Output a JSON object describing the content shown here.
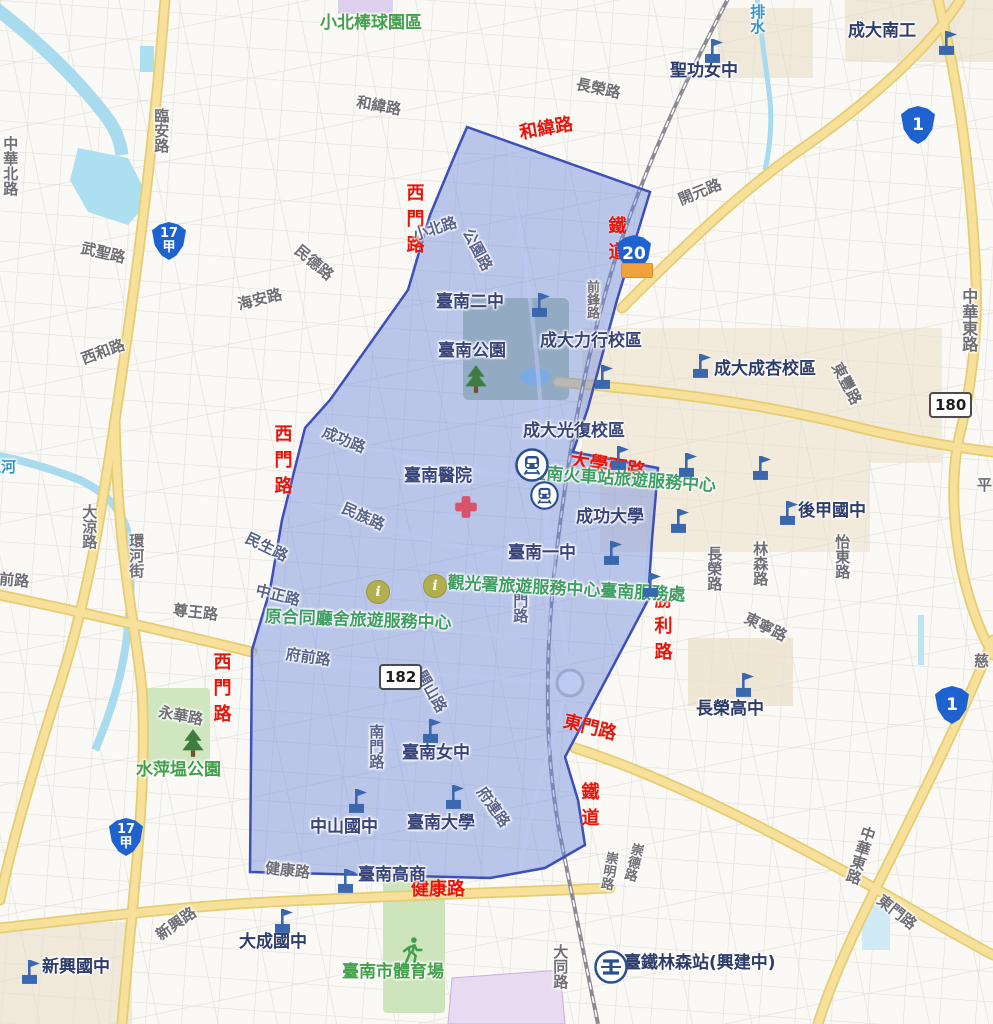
{
  "title": "臺南市街道地圖（藍色標示範圍）",
  "colors": {
    "highlight_fill": "rgba(106,136,222,0.45)",
    "highlight_stroke": "#3d4fb8",
    "annotation_red": "#e8150b",
    "place_navy": "#2e3c6a",
    "service_green": "#3f9e63",
    "park_green": "#43a04b",
    "road_gray": "#6e6e74",
    "water_blue": "#3a93c8",
    "major_road_yellow": "#f6df92",
    "railway_gray": "#8b8b93"
  },
  "highlight_region": {
    "points": "467,127 650,192 617,300 588,408 573,452 658,468 652,540 648,600 565,757 578,800 585,845 545,868 490,878 250,872 252,650 270,590 282,520 305,428 330,400 408,290 430,215 452,162"
  },
  "map": {
    "labels": [
      {
        "t": "和緯路",
        "x": 518,
        "y": 124,
        "r": -10,
        "c": "red"
      },
      {
        "t": "西門路",
        "x": 404,
        "y": 183,
        "v": 1,
        "c": "red"
      },
      {
        "t": "鐵道",
        "x": 606,
        "y": 216,
        "v": 1,
        "c": "red"
      },
      {
        "t": "西門路",
        "x": 272,
        "y": 424,
        "v": 1,
        "c": "red"
      },
      {
        "t": "大學西路",
        "x": 572,
        "y": 450,
        "r": 9,
        "c": "red",
        "s": 19
      },
      {
        "t": "勝利路",
        "x": 652,
        "y": 590,
        "v": 1,
        "c": "red"
      },
      {
        "t": "東門路",
        "x": 566,
        "y": 712,
        "r": 14,
        "c": "red"
      },
      {
        "t": "鐵道",
        "x": 579,
        "y": 782,
        "v": 1,
        "c": "red"
      },
      {
        "t": "健康路",
        "x": 411,
        "y": 880,
        "c": "red"
      },
      {
        "t": "西門路",
        "x": 211,
        "y": 652,
        "v": 1,
        "c": "red"
      },
      {
        "t": "中華北路",
        "x": 2,
        "y": 136,
        "v": 1,
        "c": "road"
      },
      {
        "t": "臨安路",
        "x": 153,
        "y": 108,
        "v": 1,
        "c": "road"
      },
      {
        "t": "武聖路",
        "x": 83,
        "y": 240,
        "r": 13,
        "c": "road"
      },
      {
        "t": "西和路",
        "x": 79,
        "y": 352,
        "r": -20,
        "c": "road"
      },
      {
        "t": "海安路",
        "x": 236,
        "y": 297,
        "r": -14,
        "c": "road"
      },
      {
        "t": "和緯路",
        "x": 358,
        "y": 94,
        "r": 10,
        "c": "road"
      },
      {
        "t": "長榮路",
        "x": 578,
        "y": 76,
        "r": 12,
        "c": "road"
      },
      {
        "t": "開元路",
        "x": 676,
        "y": 193,
        "r": -22,
        "c": "road"
      },
      {
        "t": "民德路",
        "x": 302,
        "y": 242,
        "r": 40,
        "c": "road"
      },
      {
        "t": "前鋒路",
        "x": 584,
        "y": 280,
        "v": 1,
        "c": "road",
        "s": 13
      },
      {
        "t": "尊王路",
        "x": 174,
        "y": 602,
        "r": 6,
        "c": "road"
      },
      {
        "t": "永華路",
        "x": 160,
        "y": 704,
        "r": 10,
        "c": "road"
      },
      {
        "t": "環河街",
        "x": 128,
        "y": 533,
        "v": 1,
        "c": "road"
      },
      {
        "t": "大涼路",
        "x": 81,
        "y": 504,
        "v": 1,
        "c": "road"
      },
      {
        "t": "前路",
        "x": 0,
        "y": 571,
        "r": 5,
        "c": "road"
      },
      {
        "t": "大同路",
        "x": 552,
        "y": 944,
        "v": 1,
        "c": "road"
      },
      {
        "t": "東門路",
        "x": 884,
        "y": 892,
        "r": 38,
        "c": "road"
      },
      {
        "t": "崇明路",
        "x": 604,
        "y": 850,
        "v": 1,
        "r": 10,
        "c": "road",
        "s": 13
      },
      {
        "t": "崇德路",
        "x": 630,
        "y": 841,
        "v": 1,
        "r": 14,
        "c": "road",
        "s": 13
      },
      {
        "t": "中華東路",
        "x": 862,
        "y": 824,
        "v": 1,
        "r": 18,
        "c": "road"
      },
      {
        "t": "中華東路",
        "x": 960,
        "y": 288,
        "v": 1,
        "c": "road",
        "s": 16
      },
      {
        "t": "東豐路",
        "x": 843,
        "y": 360,
        "r": 62,
        "c": "road"
      },
      {
        "t": "東寧路",
        "x": 749,
        "y": 610,
        "r": 26,
        "c": "road"
      },
      {
        "t": "林森路",
        "x": 752,
        "y": 541,
        "v": 1,
        "c": "road"
      },
      {
        "t": "長榮路",
        "x": 706,
        "y": 546,
        "v": 1,
        "c": "road"
      },
      {
        "t": "怡東路",
        "x": 834,
        "y": 534,
        "v": 1,
        "c": "road"
      },
      {
        "t": "平",
        "x": 977,
        "y": 477,
        "c": "road"
      },
      {
        "t": "慈",
        "x": 974,
        "y": 653,
        "c": "road"
      },
      {
        "t": "新興路",
        "x": 153,
        "y": 930,
        "r": -35,
        "c": "road"
      },
      {
        "t": "健康路",
        "x": 266,
        "y": 860,
        "r": 6,
        "c": "road"
      },
      {
        "t": "小北路",
        "x": 411,
        "y": 228,
        "r": -18,
        "c": "roadin"
      },
      {
        "t": "公園路",
        "x": 474,
        "y": 226,
        "r": 62,
        "c": "roadin"
      },
      {
        "t": "成功路",
        "x": 326,
        "y": 424,
        "r": 22,
        "c": "roadin"
      },
      {
        "t": "民族路",
        "x": 346,
        "y": 500,
        "r": 24,
        "c": "roadin"
      },
      {
        "t": "民生路",
        "x": 250,
        "y": 530,
        "r": 26,
        "c": "roadin"
      },
      {
        "t": "中正路",
        "x": 258,
        "y": 582,
        "r": 14,
        "c": "roadin"
      },
      {
        "t": "府前路",
        "x": 287,
        "y": 646,
        "r": 8,
        "c": "roadin"
      },
      {
        "t": "開山路",
        "x": 427,
        "y": 668,
        "r": 60,
        "c": "roadin"
      },
      {
        "t": "南門路",
        "x": 368,
        "y": 724,
        "v": 1,
        "c": "roadin"
      },
      {
        "t": "北門路",
        "x": 512,
        "y": 578,
        "v": 1,
        "c": "roadin"
      },
      {
        "t": "府連路",
        "x": 487,
        "y": 784,
        "r": 55,
        "c": "roadin"
      },
      {
        "t": "運河",
        "x": -14,
        "y": 459,
        "c": "water"
      },
      {
        "t": "排水",
        "x": 749,
        "y": 4,
        "v": 1,
        "c": "water"
      },
      {
        "t": "小北棒球園區",
        "x": 320,
        "y": 14,
        "c": "park"
      },
      {
        "t": "水萍塭公園",
        "x": 136,
        "y": 761,
        "c": "park"
      },
      {
        "t": "臺南市體育場",
        "x": 342,
        "y": 963,
        "c": "park"
      },
      {
        "t": "臺南火車站旅遊服務中心",
        "x": 530,
        "y": 464,
        "r": 4,
        "c": "svc"
      },
      {
        "t": "觀光署旅遊服務中心臺南服務處",
        "x": 448,
        "y": 574,
        "r": 3,
        "c": "svc"
      },
      {
        "t": "原合同廳舍旅遊服務中心",
        "x": 265,
        "y": 608,
        "r": 2,
        "c": "svc"
      },
      {
        "t": "聖功女中",
        "x": 670,
        "y": 62,
        "c": "place"
      },
      {
        "t": "成大南工",
        "x": 848,
        "y": 22,
        "c": "place"
      },
      {
        "t": "成大成杏校區",
        "x": 714,
        "y": 360,
        "c": "place"
      },
      {
        "t": "後甲國中",
        "x": 798,
        "y": 502,
        "c": "place"
      },
      {
        "t": "長榮高中",
        "x": 696,
        "y": 700,
        "c": "place"
      },
      {
        "t": "新興國中",
        "x": 42,
        "y": 958,
        "c": "place"
      },
      {
        "t": "大成國中",
        "x": 239,
        "y": 933,
        "c": "place"
      },
      {
        "t": "臺鐵林森站(興建中)",
        "x": 624,
        "y": 954,
        "c": "place"
      },
      {
        "t": "臺南二中",
        "x": 436,
        "y": 293,
        "c": "placein"
      },
      {
        "t": "臺南公園",
        "x": 438,
        "y": 342,
        "c": "placein"
      },
      {
        "t": "成大力行校區",
        "x": 540,
        "y": 332,
        "c": "placein"
      },
      {
        "t": "成大光復校區",
        "x": 523,
        "y": 422,
        "c": "placein"
      },
      {
        "t": "成功大學",
        "x": 576,
        "y": 508,
        "c": "placein"
      },
      {
        "t": "臺南一中",
        "x": 508,
        "y": 544,
        "c": "placein"
      },
      {
        "t": "臺南醫院",
        "x": 404,
        "y": 467,
        "c": "placein"
      },
      {
        "t": "臺南女中",
        "x": 402,
        "y": 744,
        "c": "placein"
      },
      {
        "t": "中山國中",
        "x": 310,
        "y": 818,
        "c": "placein"
      },
      {
        "t": "臺南大學",
        "x": 407,
        "y": 814,
        "c": "placein"
      },
      {
        "t": "臺南高商",
        "x": 358,
        "y": 866,
        "c": "placein"
      }
    ],
    "shields": [
      {
        "style": "prov",
        "lines": [
          "1"
        ],
        "x": 901,
        "y": 106
      },
      {
        "style": "prov",
        "lines": [
          "1"
        ],
        "x": 935,
        "y": 686
      },
      {
        "style": "prov",
        "lines": [
          "17",
          "甲"
        ],
        "x": 152,
        "y": 222
      },
      {
        "style": "prov",
        "lines": [
          "17",
          "甲"
        ],
        "x": 109,
        "y": 818
      },
      {
        "style": "prov",
        "lines": [
          "20"
        ],
        "x": 617,
        "y": 235
      },
      {
        "style": "rect",
        "lines": [
          "180"
        ],
        "x": 929,
        "y": 392
      },
      {
        "style": "rect",
        "lines": [
          "182"
        ],
        "x": 379,
        "y": 664
      }
    ],
    "icons": [
      {
        "type": "flag",
        "x": 700,
        "y": 36
      },
      {
        "type": "flag",
        "x": 934,
        "y": 28
      },
      {
        "type": "flag",
        "x": 527,
        "y": 290
      },
      {
        "type": "flag",
        "x": 590,
        "y": 362
      },
      {
        "type": "flag",
        "x": 688,
        "y": 351
      },
      {
        "type": "flag",
        "x": 606,
        "y": 443
      },
      {
        "type": "flag",
        "x": 674,
        "y": 450
      },
      {
        "type": "flag",
        "x": 748,
        "y": 453
      },
      {
        "type": "flag",
        "x": 666,
        "y": 506
      },
      {
        "type": "flag",
        "x": 599,
        "y": 538
      },
      {
        "type": "flag",
        "x": 775,
        "y": 498
      },
      {
        "type": "flag",
        "x": 731,
        "y": 670
      },
      {
        "type": "flag",
        "x": 418,
        "y": 716
      },
      {
        "type": "flag",
        "x": 344,
        "y": 786
      },
      {
        "type": "flag",
        "x": 441,
        "y": 782
      },
      {
        "type": "flag",
        "x": 333,
        "y": 866
      },
      {
        "type": "flag",
        "x": 17,
        "y": 957
      },
      {
        "type": "flag",
        "x": 270,
        "y": 906
      },
      {
        "type": "flag",
        "x": 638,
        "y": 570
      },
      {
        "type": "station",
        "x": 515,
        "y": 448,
        "s": 34
      },
      {
        "type": "station",
        "x": 530,
        "y": 481,
        "s": 29
      },
      {
        "type": "tra",
        "x": 594,
        "y": 950,
        "s": 34
      },
      {
        "type": "info",
        "x": 366,
        "y": 580,
        "s": 22,
        "glyph": "i"
      },
      {
        "type": "info",
        "x": 423,
        "y": 574,
        "s": 22,
        "glyph": "i"
      },
      {
        "type": "tree",
        "x": 463,
        "y": 364,
        "s": 26
      },
      {
        "type": "tree",
        "x": 180,
        "y": 728,
        "s": 26
      },
      {
        "type": "hospital",
        "x": 453,
        "y": 494,
        "s": 26
      },
      {
        "type": "runner",
        "x": 397,
        "y": 936,
        "s": 28
      },
      {
        "type": "orangetag",
        "x": 621,
        "y": 263,
        "s": 30
      }
    ]
  }
}
